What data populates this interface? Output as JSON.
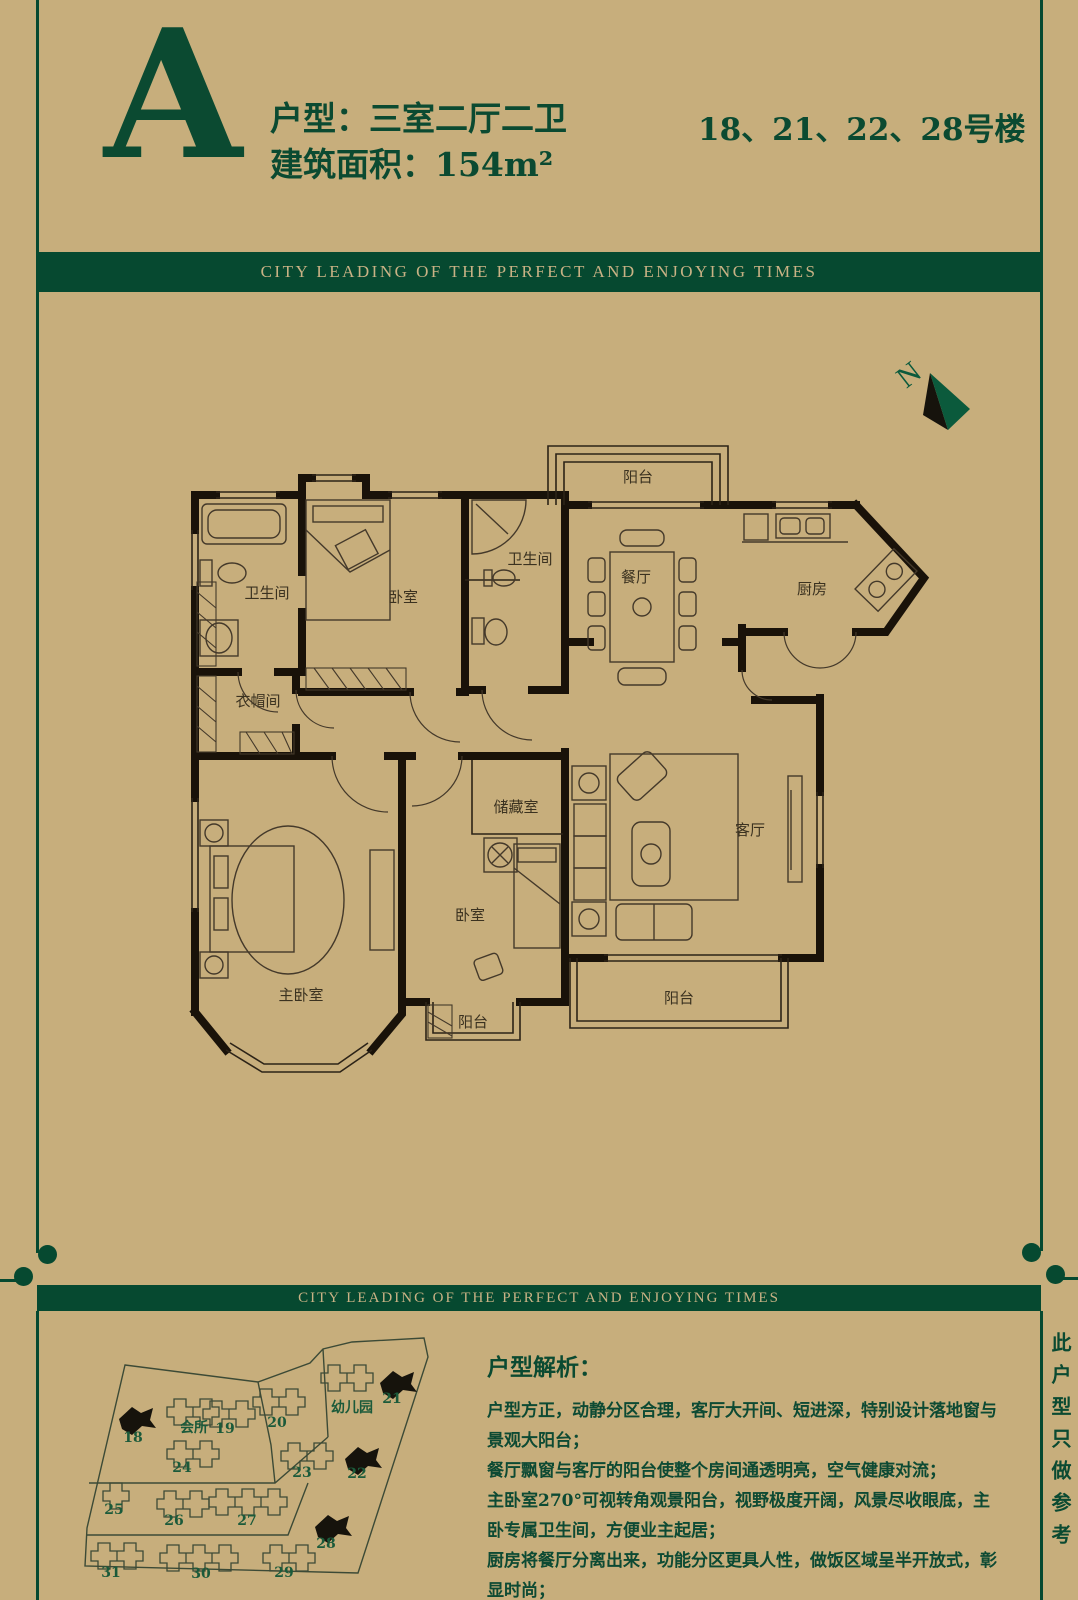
{
  "palette": {
    "background": "#c7ae7c",
    "green": "#064930",
    "banner_text": "#c9b285",
    "heading_green": "#0b4a31",
    "plan_ink": "#191209",
    "site_number_green": "#1b5a3a"
  },
  "header": {
    "type_letter": "A",
    "type_line": "户型：三室二厅二卫",
    "area_line": "建筑面积：154m²",
    "buildings_line": "18、21、22、28号楼"
  },
  "banner": {
    "text": "CITY LEADING OF THE PERFECT AND ENJOYING TIMES"
  },
  "compass": {
    "label": "N"
  },
  "floorplan": {
    "labels": [
      {
        "t": "阳台",
        "x": 458,
        "y": 52
      },
      {
        "t": "卫生间",
        "x": 87,
        "y": 168
      },
      {
        "t": "卧室",
        "x": 223,
        "y": 172
      },
      {
        "t": "卫生间",
        "x": 350,
        "y": 134
      },
      {
        "t": "餐厅",
        "x": 456,
        "y": 152
      },
      {
        "t": "厨房",
        "x": 632,
        "y": 164
      },
      {
        "t": "衣帽间",
        "x": 78,
        "y": 276
      },
      {
        "t": "储藏室",
        "x": 336,
        "y": 382
      },
      {
        "t": "客厅",
        "x": 570,
        "y": 405
      },
      {
        "t": "主卧室",
        "x": 121,
        "y": 570
      },
      {
        "t": "卧室",
        "x": 290,
        "y": 490
      },
      {
        "t": "阳台",
        "x": 293,
        "y": 597
      },
      {
        "t": "阳台",
        "x": 499,
        "y": 573
      }
    ]
  },
  "sitemap": {
    "buildings": [
      {
        "label": "18",
        "filled": true,
        "x": 44,
        "y": 80,
        "units": 0,
        "lx": 58,
        "ly": 117
      },
      {
        "label": "会所",
        "filled": false,
        "x": 92,
        "y": 74,
        "units": 2,
        "lx": 119,
        "ly": 107
      },
      {
        "label": "19",
        "filled": false,
        "x": 128,
        "y": 76,
        "units": 2,
        "lx": 150,
        "ly": 108
      },
      {
        "label": "20",
        "filled": false,
        "x": 178,
        "y": 64,
        "units": 2,
        "lx": 202,
        "ly": 102
      },
      {
        "label": "幼儿园",
        "filled": false,
        "x": 246,
        "y": 40,
        "units": 2,
        "lx": 277,
        "ly": 87
      },
      {
        "label": "21",
        "filled": true,
        "x": 305,
        "y": 44,
        "units": 0,
        "lx": 317,
        "ly": 78
      },
      {
        "label": "24",
        "filled": false,
        "x": 92,
        "y": 116,
        "units": 2,
        "lx": 107,
        "ly": 147
      },
      {
        "label": "23",
        "filled": false,
        "x": 206,
        "y": 118,
        "units": 2,
        "lx": 227,
        "ly": 152
      },
      {
        "label": "22",
        "filled": true,
        "x": 270,
        "y": 120,
        "units": 0,
        "lx": 282,
        "ly": 153
      },
      {
        "label": "25",
        "filled": false,
        "x": 28,
        "y": 158,
        "units": 1,
        "lx": 39,
        "ly": 189
      },
      {
        "label": "26",
        "filled": false,
        "x": 82,
        "y": 166,
        "units": 2,
        "lx": 99,
        "ly": 200
      },
      {
        "label": "27",
        "filled": false,
        "x": 134,
        "y": 164,
        "units": 3,
        "lx": 172,
        "ly": 200
      },
      {
        "label": "28",
        "filled": true,
        "x": 240,
        "y": 188,
        "units": 0,
        "lx": 251,
        "ly": 223
      },
      {
        "label": "31",
        "filled": false,
        "x": 16,
        "y": 218,
        "units": 2,
        "lx": 36,
        "ly": 252
      },
      {
        "label": "30",
        "filled": false,
        "x": 85,
        "y": 220,
        "units": 3,
        "lx": 126,
        "ly": 253
      },
      {
        "label": "29",
        "filled": false,
        "x": 188,
        "y": 220,
        "units": 2,
        "lx": 209,
        "ly": 252
      }
    ]
  },
  "analysis": {
    "title": "户型解析：",
    "lines": [
      "户型方正，动静分区合理，客厅大开间、短进深，特别设计落地窗与景观大阳台；",
      "餐厅飘窗与客厅的阳台使整个房间通透明亮，空气健康对流；",
      "主卧室270°可视转角观景阳台，视野极度开阔，风景尽收眼底，主卧专属卫生间，方便业主起居；",
      "厨房将餐厅分离出来，功能分区更具人性，做饭区域呈半开放式，彰显时尚；",
      "双明卫设计，干湿分离，居家生活从此清新便捷。"
    ]
  },
  "side_note": {
    "text": "此户型只做参考"
  }
}
